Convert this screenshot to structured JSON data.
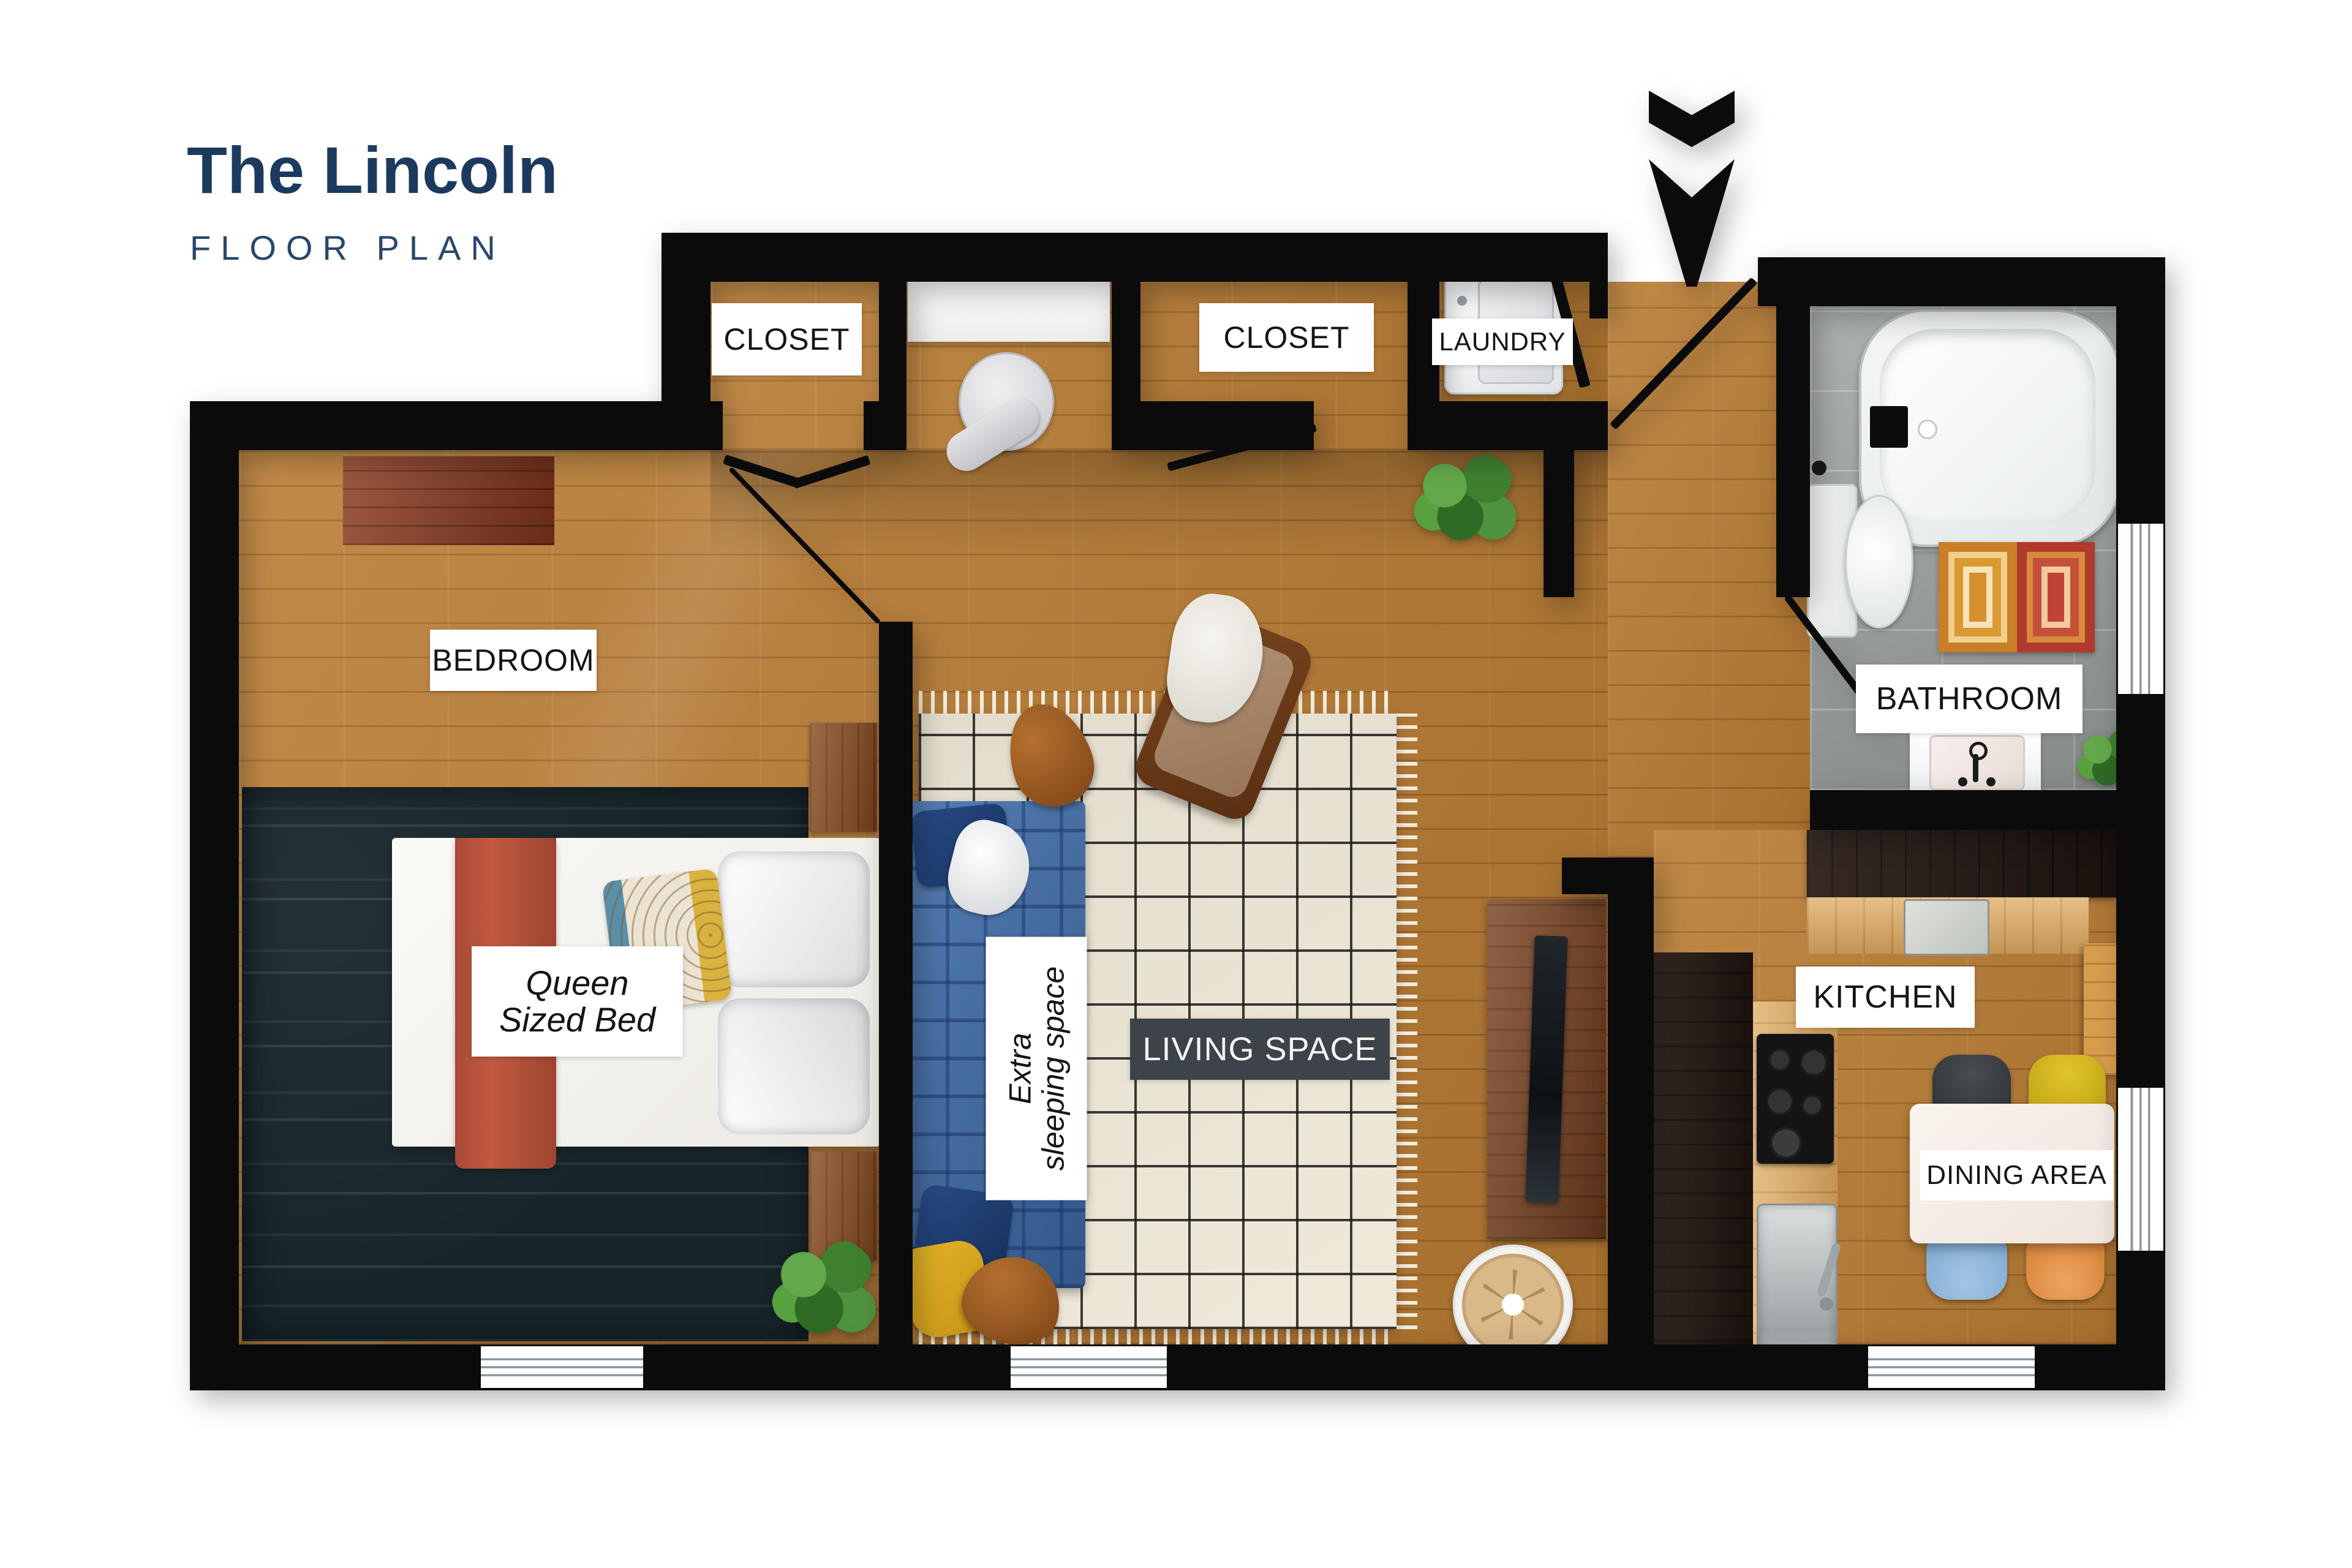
{
  "title": {
    "name": "The Lincoln",
    "subtitle": "FLOOR PLAN"
  },
  "rooms": {
    "bedroom": "BEDROOM",
    "closet_left": "CLOSET",
    "closet_right": "CLOSET",
    "laundry": "LAUNDRY",
    "bathroom": "BATHROOM",
    "kitchen": "KITCHEN",
    "living_space": "LIVING SPACE",
    "dining_area": "DINING AREA"
  },
  "annotations": {
    "queen_bed": {
      "line1": "Queen",
      "line2": "Sized Bed"
    },
    "extra_sleeping": {
      "line1": "Extra",
      "line2": "sleeping space"
    }
  },
  "icons": {
    "entry": "entry-arrow-down-icon"
  },
  "colors": {
    "title_navy": "#1c3a5e",
    "subtitle_navy": "#27476b",
    "wall_black": "#0b0b0b",
    "wood_floor": "#b97c33",
    "bath_tile": "#9ba19f",
    "living_label_bg": "#3c4349",
    "sofa_blue": "#3e6ba9",
    "bed_runner_red": "#b5533c",
    "navy_rug": "#18262c",
    "cream_rug": "#efe8d8",
    "bath_rug_orange": "#d78e2c",
    "bath_rug_red": "#c04435",
    "chair_black": "#3b3e42",
    "chair_yellow": "#d2b31c",
    "chair_blue": "#93bada",
    "chair_orange": "#e2904e",
    "throw_yellow": "#d9a81e"
  }
}
